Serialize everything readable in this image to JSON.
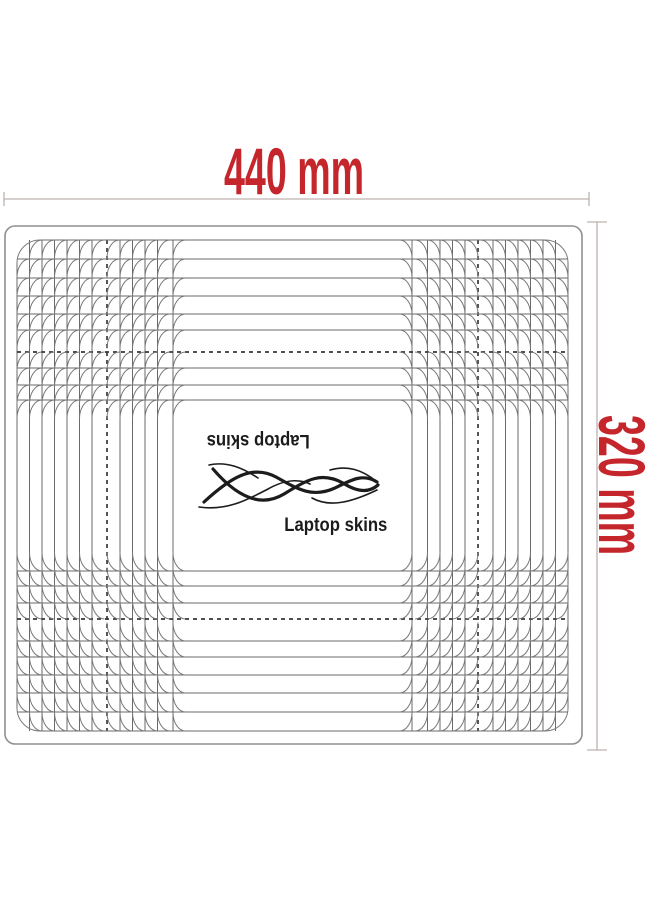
{
  "colors": {
    "background": "#ffffff",
    "dimension_text": "#c5262c",
    "dimension_line": "#bdb2b0",
    "sheet_border": "#8f8f8f",
    "grid_line": "#6a6a6a",
    "arc_line": "#7a7a7a",
    "dash_line": "#383838",
    "brand_text": "#1c1c1c"
  },
  "dimensions": {
    "width_label": "440 mm",
    "height_label": "320 mm",
    "top_line": {
      "y": 199,
      "x1": 4,
      "x2": 589,
      "tick_half": 7
    },
    "right_line": {
      "x": 597,
      "y1": 222,
      "y2": 750,
      "tick_half": 10
    }
  },
  "branding": {
    "name_top_inverted": "Laptop skins",
    "name_bottom": "Laptop skins"
  },
  "template_sheet": {
    "sheet": {
      "x": 5,
      "y": 226,
      "w": 577,
      "h": 518,
      "r": 10
    },
    "geometry": {
      "x0": 17,
      "x1": 568,
      "y0": 240,
      "y1": 731,
      "v_offsets": [
        0,
        12.5,
        25,
        37.5,
        50,
        62.5,
        75,
        90,
        103,
        115.5,
        128,
        140.5,
        156
      ],
      "h_offsets": [
        0,
        19,
        38,
        56,
        74,
        90,
        112,
        128,
        145,
        160
      ],
      "v_dashed_index": 7,
      "h_dashed_index": 6,
      "outer_radius": 23,
      "arc_rx": 12.5,
      "arc_ry": 18.5
    }
  }
}
